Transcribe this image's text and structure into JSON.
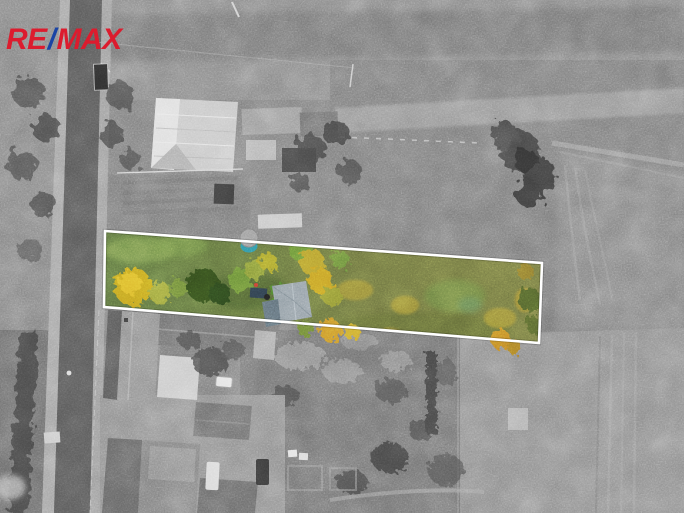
{
  "branding": {
    "logo_text_1": "RE",
    "logo_slash": "/",
    "logo_text_2": "MAX",
    "colors": {
      "red": "#DC1C2E",
      "blue": "#1A44A5"
    }
  },
  "photo": {
    "type": "aerial-drone-photo",
    "style": "grayscale aerial photograph with one land parcel highlighted in natural color and outlined in white",
    "parcel": {
      "outline_color": "#FFFFFF",
      "outline_width_px": 2.6,
      "corners": [
        [
          105,
          231
        ],
        [
          542,
          263
        ],
        [
          539,
          343
        ],
        [
          104,
          307
        ]
      ]
    },
    "palette": {
      "grayscale_base": "#7d7d7d",
      "road_asphalt": "#575757",
      "barn_roof_light": "#c9c9c9",
      "parcel_meadow_green": "#5f7040",
      "parcel_meadow_olive": "#6f7340",
      "autumn_yellow": "#c7a524",
      "autumn_orange": "#c78f2a",
      "conifer_dark_green": "#30491f",
      "garden_shed_roof": "#8d99a1",
      "water_tank_teal": "#2f8c9e"
    },
    "landmarks": [
      "road-left",
      "truck-on-road",
      "barn-top-left",
      "outbuildings",
      "garden-rows",
      "highlighted-parcel",
      "garden-shed",
      "water-tank",
      "houses-bottom-left",
      "field-top",
      "field-right",
      "field-bottom-right",
      "large-bush",
      "tractor-tracks"
    ]
  }
}
